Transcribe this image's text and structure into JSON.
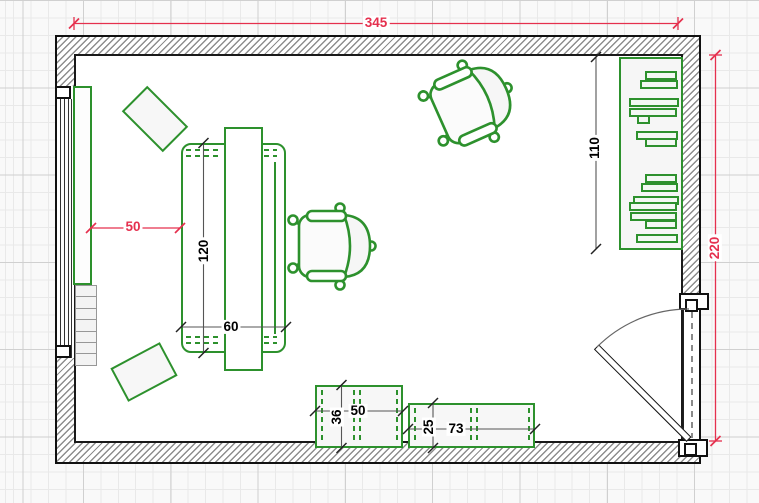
{
  "plan": {
    "dimensions": {
      "room_width": "345",
      "room_depth": "220",
      "shelf_span": "110",
      "wall_to_desk": "50",
      "desk_length": "120",
      "desk_width": "60",
      "box_a_depth": "36",
      "box_a_width": "50",
      "box_b_depth": "25",
      "box_b_width": "73"
    },
    "colors": {
      "dimension_red": "#e5304e",
      "furniture_green": "#2d912d",
      "wall_line": "#1a1a1a",
      "dimension_dark": "#555555"
    },
    "bookshelf_books": [
      {
        "t": 12,
        "l": 24,
        "w": 32
      },
      {
        "t": 21,
        "l": 19,
        "w": 38
      },
      {
        "t": 39,
        "l": 8,
        "w": 50
      },
      {
        "t": 49,
        "l": 8,
        "w": 48
      },
      {
        "t": 56,
        "l": 16,
        "w": 13
      },
      {
        "t": 72,
        "l": 15,
        "w": 42
      },
      {
        "t": 79,
        "l": 24,
        "w": 32
      },
      {
        "t": 115,
        "l": 24,
        "w": 32
      },
      {
        "t": 124,
        "l": 20,
        "w": 37
      },
      {
        "t": 137,
        "l": 12,
        "w": 46
      },
      {
        "t": 143,
        "l": 8,
        "w": 48
      },
      {
        "t": 153,
        "l": 9,
        "w": 47
      },
      {
        "t": 161,
        "l": 24,
        "w": 32
      },
      {
        "t": 175,
        "l": 15,
        "w": 42
      }
    ]
  }
}
